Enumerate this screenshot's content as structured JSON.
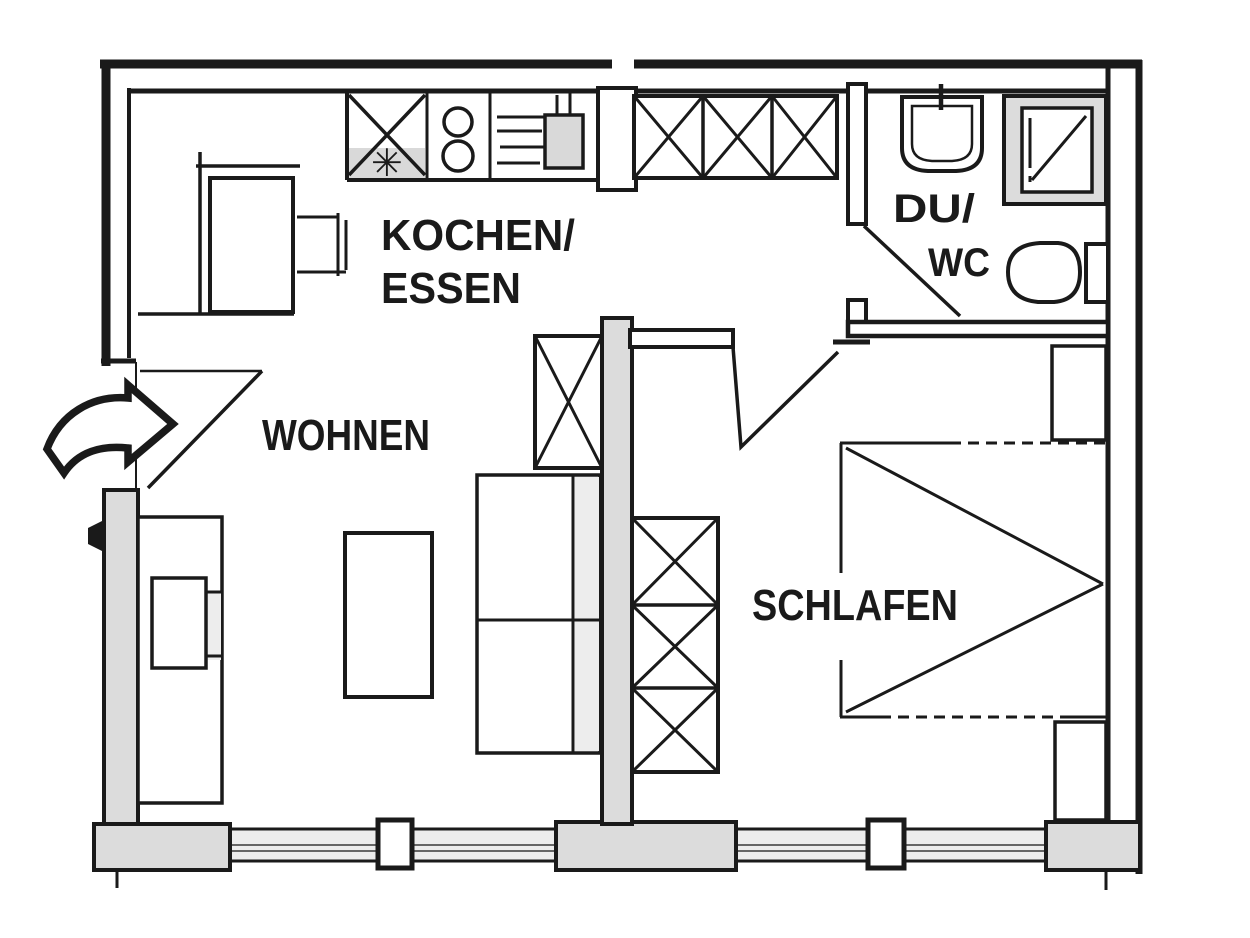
{
  "rooms": {
    "kitchen": {
      "label_line1": "KOCHEN/",
      "label_line2": "ESSEN"
    },
    "living": {
      "label": "WOHNEN"
    },
    "bathroom": {
      "label_line1": "DU/",
      "label_line2": "WC"
    },
    "bedroom": {
      "label": "SCHLAFEN"
    }
  },
  "symbols": {
    "kitchen_sink_star": "✳"
  },
  "icons": [
    "entrance-arrow",
    "door-swing",
    "window",
    "window-mullion",
    "wardrobe-crossed",
    "double-bed",
    "nightstand",
    "sofa",
    "coffee-table",
    "tv-sideboard",
    "dining-table",
    "dining-bench",
    "dining-chair",
    "kitchen-counter",
    "sink-unit",
    "cooktop-burners",
    "kitchen-basin",
    "washbasin",
    "shower",
    "toilet"
  ],
  "colors": {
    "ink": "#1a1a1a",
    "wall_fill": "#dcdcdc",
    "appliance_shade": "#d9d9d9",
    "window_glass": "#ededed",
    "background": "#ffffff"
  }
}
